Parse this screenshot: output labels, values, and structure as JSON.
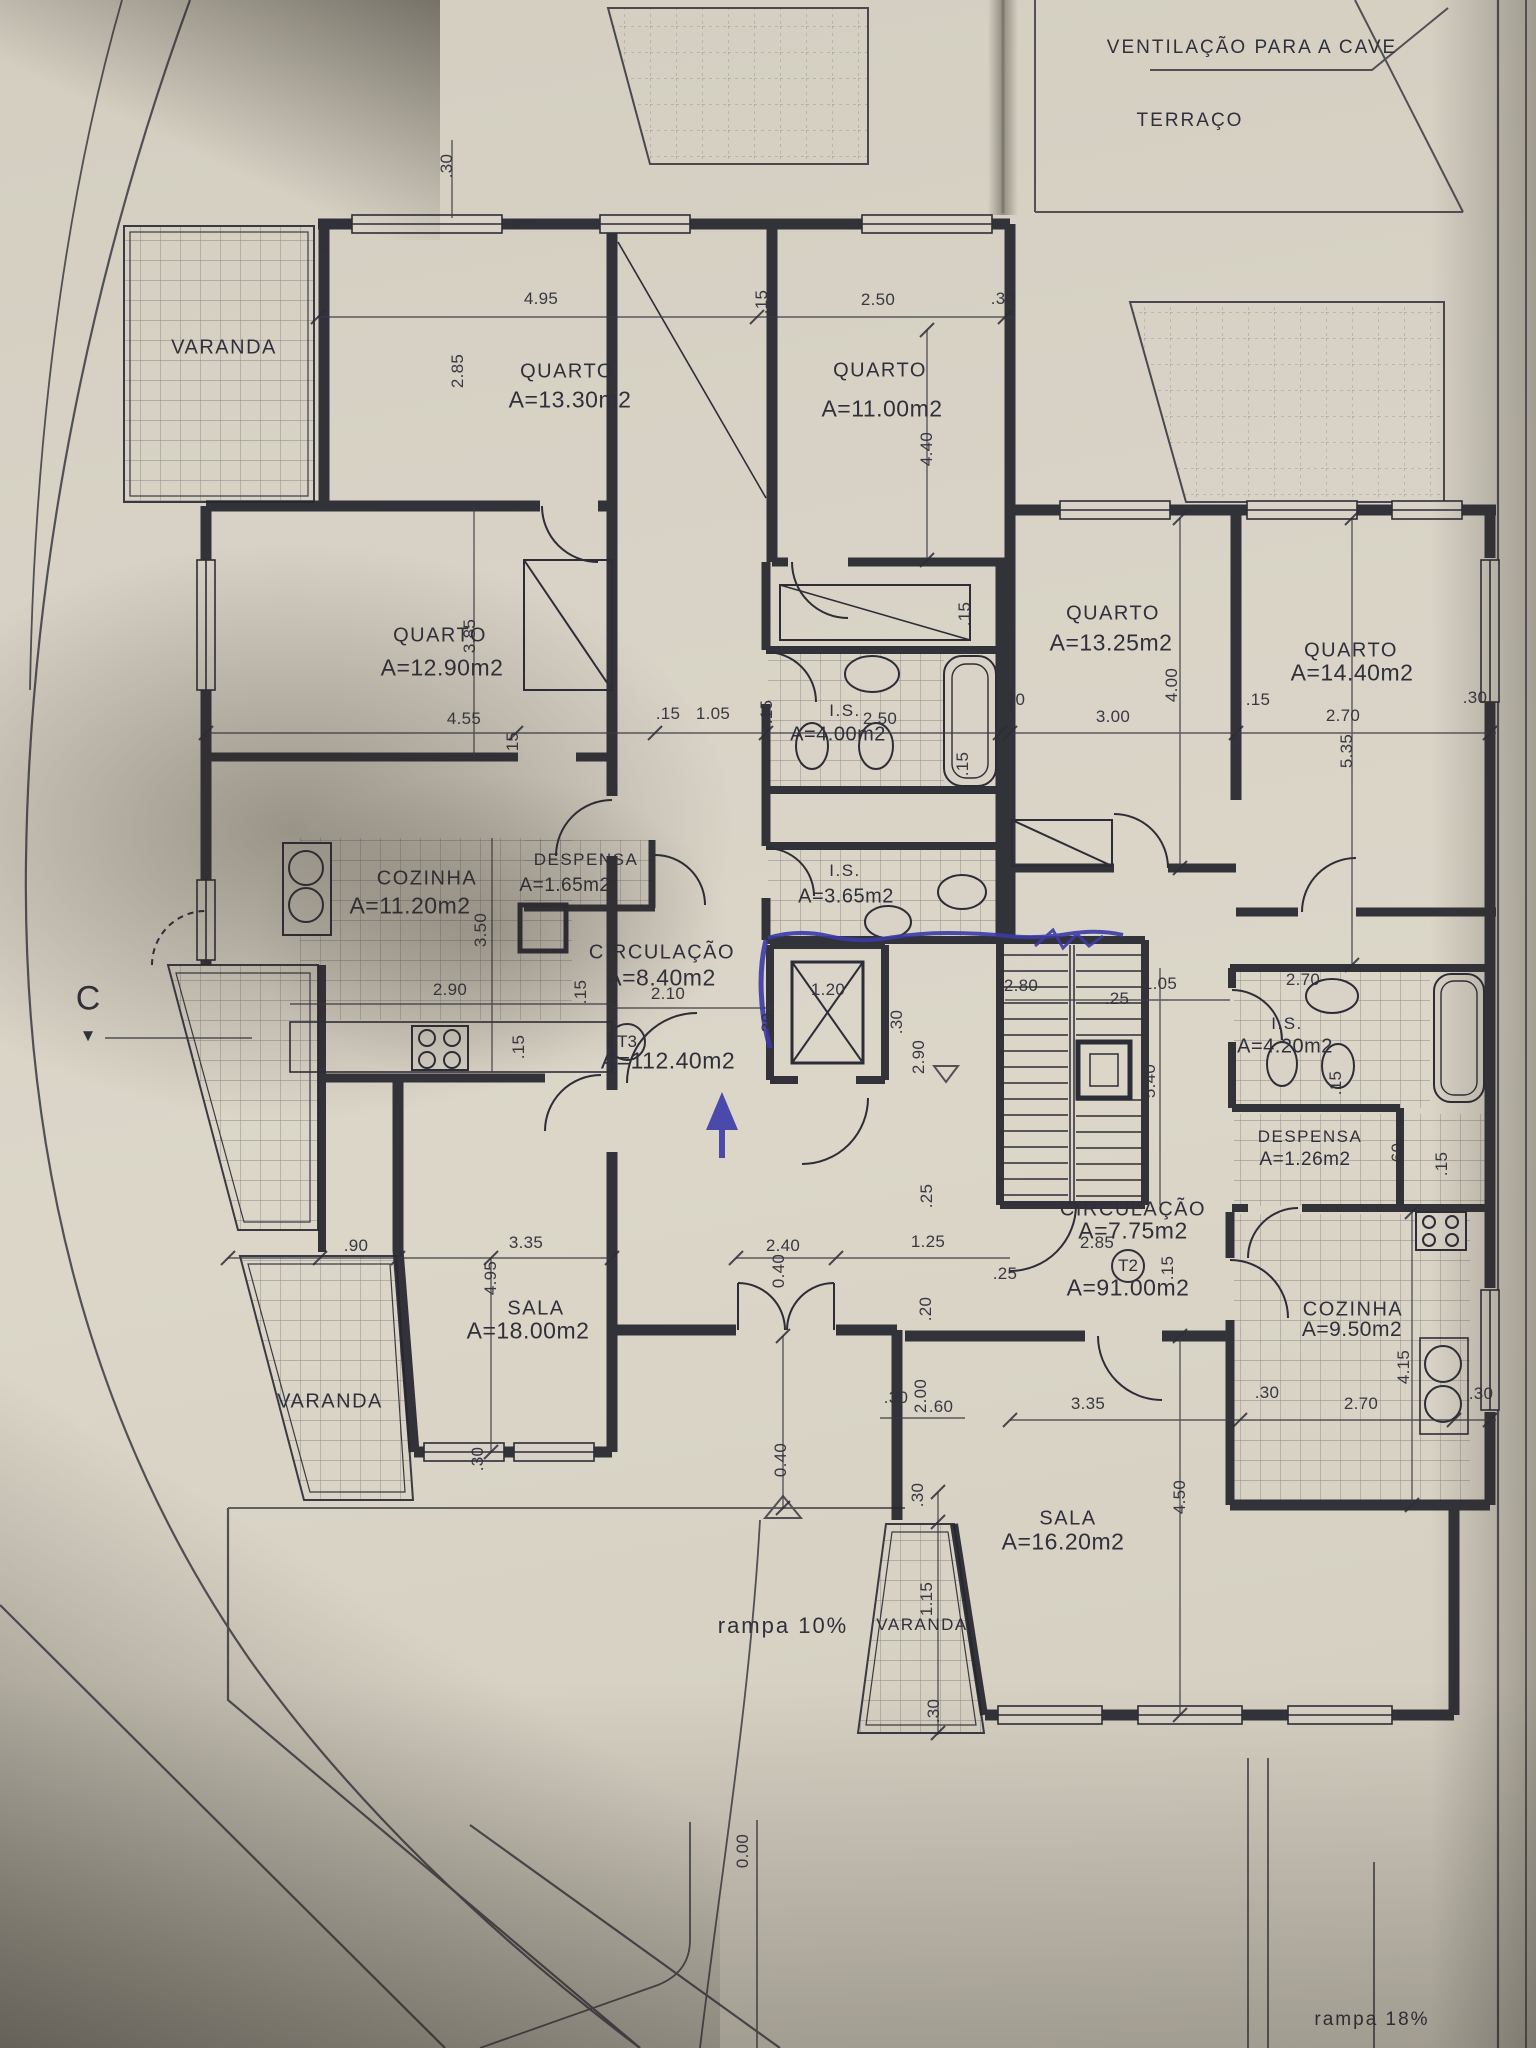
{
  "annotations": {
    "ventilation_note": "VENTILAÇÃO PARA A CAVE",
    "terrace_label": "TERRAÇO",
    "ramp_10": "rampa  10%",
    "ramp_18": "rampa  18%",
    "section_marker": "C",
    "section_arrow": "▼"
  },
  "units": {
    "t3": {
      "tag": "T3",
      "area": "A=112.40m2"
    },
    "t2": {
      "tag": "T2",
      "area": "A=91.00m2"
    }
  },
  "rooms": [
    {
      "name": "VARANDA"
    },
    {
      "name": "QUARTO",
      "area": "A=13.30m2"
    },
    {
      "name": "QUARTO",
      "area": "A=11.00m2"
    },
    {
      "name": "QUARTO",
      "area": "A=12.90m2"
    },
    {
      "name": "I.S.",
      "area": "A=4.00m2"
    },
    {
      "name": "COZINHA",
      "area": "A=11.20m2"
    },
    {
      "name": "DESPENSA",
      "area": "A=1.65m2"
    },
    {
      "name": "CIRCULAÇÃO",
      "area": "A=8.40m2"
    },
    {
      "name": "I.S.",
      "area": "A=3.65m2"
    },
    {
      "name": "SALA",
      "area": "A=18.00m2"
    },
    {
      "name": "VARANDA"
    },
    {
      "name": "QUARTO",
      "area": "A=13.25m2"
    },
    {
      "name": "QUARTO",
      "area": "A=14.40m2"
    },
    {
      "name": "I.S.",
      "area": "A=4.20m2"
    },
    {
      "name": "DESPENSA",
      "area": "A=1.26m2"
    },
    {
      "name": "CIRCULAÇÃO",
      "area": "A=7.75m2"
    },
    {
      "name": "COZINHA",
      "area": "A=9.50m2"
    },
    {
      "name": "SALA",
      "area": "A=16.20m2"
    },
    {
      "name": "VARANDA"
    }
  ],
  "dims": [
    ".30",
    "4.95",
    ".15",
    "2.50",
    ".30",
    "2.85",
    "4.40",
    "3.85",
    "4.55",
    ".15",
    ".15",
    "1.05",
    ".15",
    "2.50",
    ".15",
    ".20",
    ".15",
    "3.00",
    "4.00",
    "2.70",
    ".15",
    ".30",
    "5.35",
    "3.50",
    "2.90",
    ".15",
    ".15",
    "2.10",
    "1.20",
    ".30",
    ".30",
    "2.80",
    "2.90",
    "1.05",
    ".25",
    "2.70",
    "5.40",
    ".15",
    ".60",
    ".15",
    "2.85",
    ".15",
    ".90",
    "3.35",
    "4.95",
    ".30",
    "2.40",
    "0.40",
    ".25",
    "1.25",
    ".25",
    ".20",
    ".30",
    "2.00",
    ".60",
    ".30",
    "1.15",
    ".30",
    "3.35",
    ".30",
    "2.70",
    "4.15",
    ".30",
    "4.50",
    "0.40",
    "0.00"
  ],
  "colors": {
    "ink": "#2d2d38",
    "paper": "#d8d3c6",
    "pen": "#3c3aa6"
  }
}
